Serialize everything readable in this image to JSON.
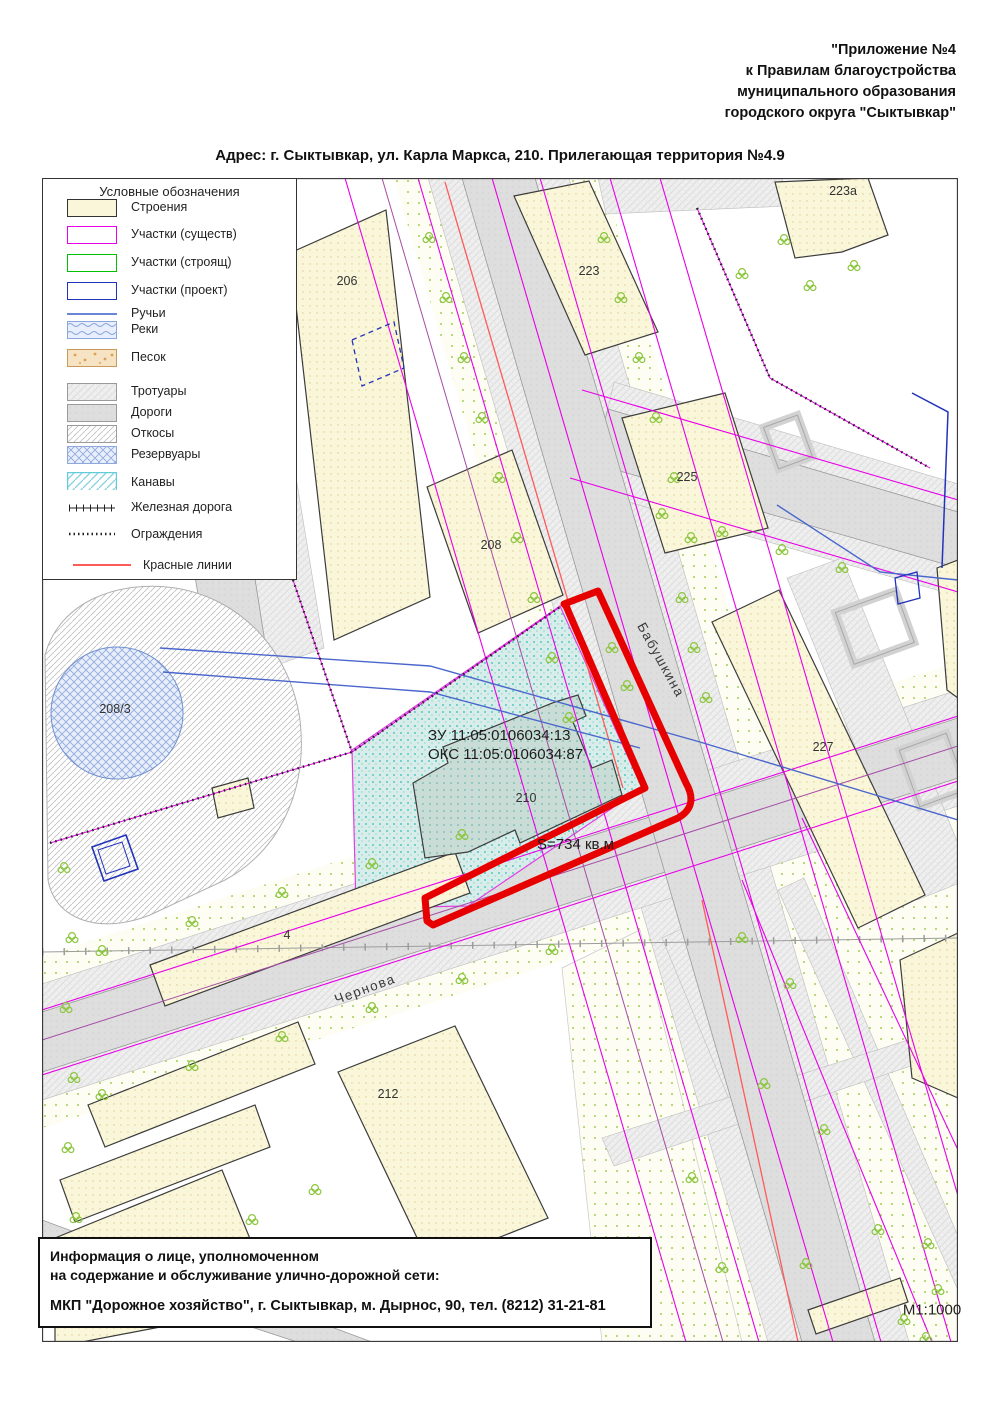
{
  "header": {
    "lines": [
      "\"Приложение №4",
      "к Правилам благоустройства",
      "муниципального образования",
      "городского округа \"Сыктывкар\""
    ]
  },
  "address": "Адрес: г. Сыктывкар, ул. Карла Маркса, 210. Прилегающая территория №4.9",
  "legend": {
    "title": "Условные обозначения",
    "items": [
      {
        "key": "buildings",
        "label": "Строения"
      },
      {
        "key": "parcels_existing",
        "label": "Участки (существ)"
      },
      {
        "key": "parcels_under_construction",
        "label": "Участки (строящ)"
      },
      {
        "key": "parcels_planned",
        "label": "Участки (проект)"
      },
      {
        "key": "streams",
        "label": "Ручьи"
      },
      {
        "key": "rivers",
        "label": "Реки"
      },
      {
        "key": "sand",
        "label": "Песок"
      },
      {
        "key": "sidewalks",
        "label": "Тротуары"
      },
      {
        "key": "roads",
        "label": "Дороги"
      },
      {
        "key": "slopes",
        "label": "Откосы"
      },
      {
        "key": "reservoirs",
        "label": "Резервуары"
      },
      {
        "key": "ditches",
        "label": "Канавы"
      },
      {
        "key": "railway",
        "label": "Железная дорога"
      },
      {
        "key": "fences",
        "label": "Ограждения"
      },
      {
        "key": "red_lines",
        "label": "Красные линии"
      }
    ]
  },
  "map": {
    "building_labels": {
      "b206": "206",
      "b223": "223",
      "b223a": "223a",
      "b225": "225",
      "b227": "227",
      "b208": "208",
      "b208_3": "208/3",
      "b210": "210",
      "b4": "4",
      "b212": "212"
    },
    "annotations": {
      "land_parcel": "ЗУ 11:05:0106034:13",
      "capital_object": "ОКС 11:05:0106034:87",
      "area": "S=734 кв.м"
    },
    "streets": {
      "babushkina": "Бабушкина",
      "chernova": "Чернова"
    },
    "scale": "М1:1000"
  },
  "info_box": {
    "lines": [
      "Информация о лице, уполномоченном",
      "на содержание и обслуживание улично-дорожной сети:"
    ],
    "contractor": "МКП \"Дорожное хозяйство\", г. Сыктывкар, м. Дырнос, 90, тел. (8212) 31-21-81"
  },
  "colors": {
    "red_boundary": "#e60000",
    "red_line": "#ff5a5a",
    "parcel_existing": "#e800e8",
    "parcel_constructing": "#00c000",
    "parcel_planned": "#2233bb",
    "stream_blue": "#4a66cc",
    "territory_teal": "#2fbdb3",
    "building_fill": "#faf6da",
    "road_gray": "#dedede"
  }
}
